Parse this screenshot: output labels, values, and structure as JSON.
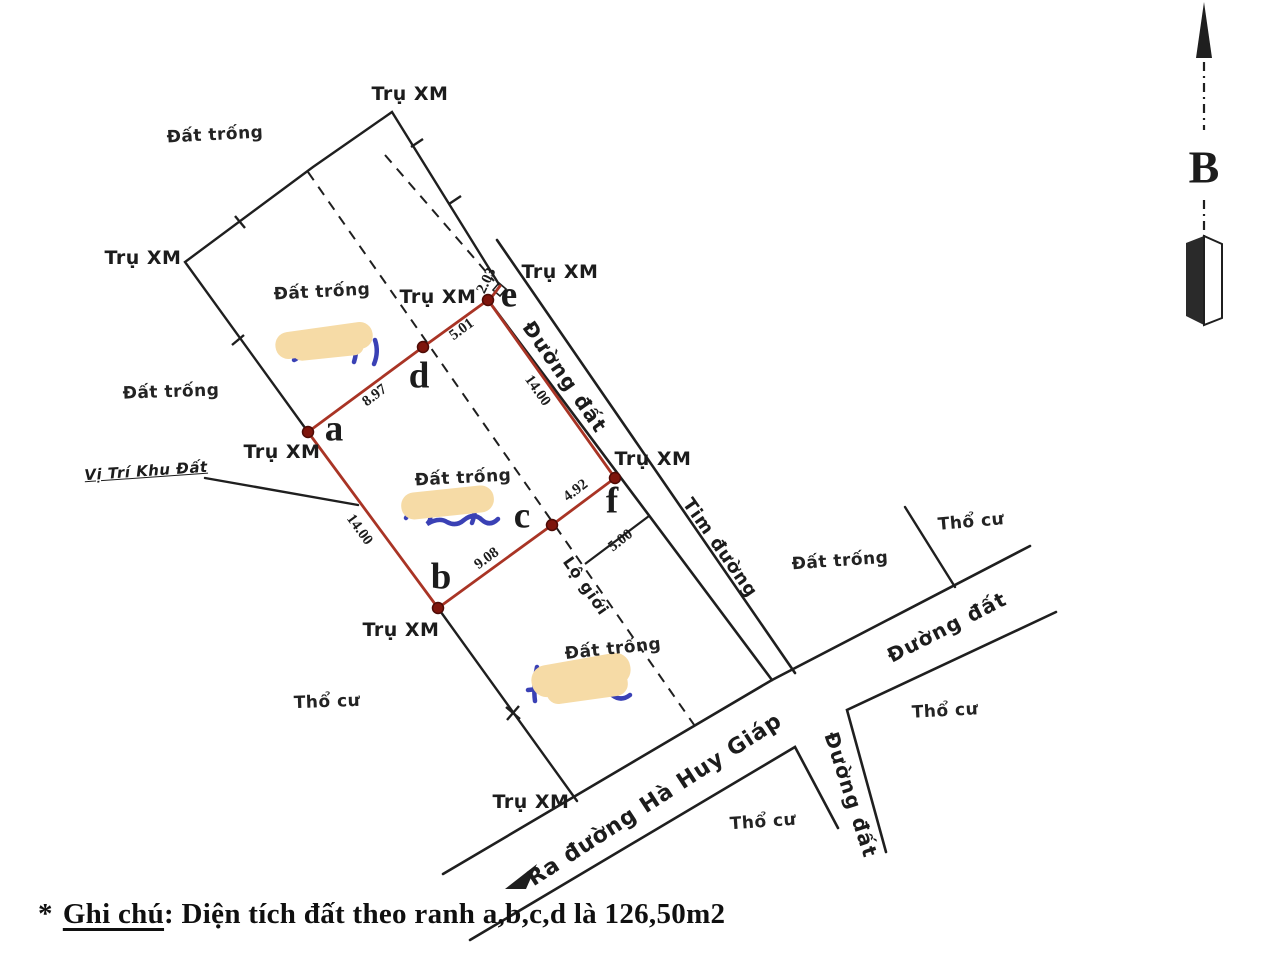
{
  "document": {
    "note_bullet": "*",
    "note_title": "Ghi chú",
    "note_body": ": Diện tích đất theo ranh a,b,c,d là 126,50m2",
    "compass_label": "B"
  },
  "map": {
    "labels": {
      "cement_post": "Trụ XM",
      "vacant_land": "Đất trống",
      "residential_land": "Thổ cư",
      "dirt_road": "Đường đất",
      "road_centerline": "Tim đường",
      "road_boundary": "Lộ giới",
      "to_road": "Ra đường Hà Huy Giáp",
      "site_location": "Vị Trí Khu Đất"
    },
    "points": {
      "a": "a",
      "b": "b",
      "c": "c",
      "d": "d",
      "e": "e",
      "f": "f"
    },
    "measurements": {
      "a_d": "8.97",
      "d_e": "5.01",
      "e_corner": "2.03",
      "e_f": "14.00",
      "a_b": "14.00",
      "b_c": "9.08",
      "c_f": "4.92",
      "road_offset": "5.00"
    },
    "colors": {
      "plot_boundary": "#a93425",
      "corner_point": "#7e150c",
      "ink": "#1f1f1f",
      "redaction_patch": "#f6dba6",
      "handwriting": "#3a41b5"
    }
  }
}
